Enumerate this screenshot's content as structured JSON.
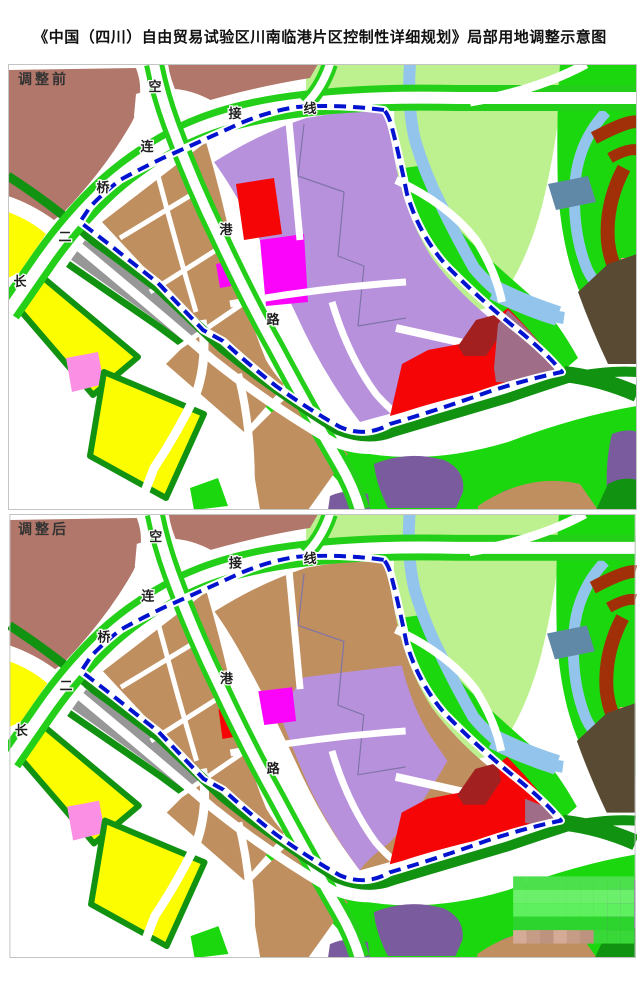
{
  "title": "《中国（四川）自由贸易试验区川南临港片区控制性详细规划》局部用地调整示意图",
  "panels": [
    {
      "id": "before",
      "label": "调整前"
    },
    {
      "id": "after",
      "label": "调整后"
    }
  ],
  "road_labels": [
    {
      "char": "空"
    },
    {
      "char": "港"
    },
    {
      "char": "路"
    },
    {
      "char": "长"
    },
    {
      "char": "二"
    },
    {
      "char": "桥"
    },
    {
      "char": "连"
    },
    {
      "char": "接"
    },
    {
      "char": "线"
    }
  ],
  "colors": {
    "white": "#ffffff",
    "paleGreen": "#bdf18f",
    "brightGreen": "#1bd80e",
    "roadGreen": "#23cf18",
    "darkGreen": "#119211",
    "yellow": "#fdfd02",
    "tan": "#c08f5f",
    "rosybrown": "#b1776a",
    "darkBrown": "#584a33",
    "purpleLight": "#b891dc",
    "purpleDark": "#7a5b9e",
    "magenta": "#fa04fa",
    "pink": "#fb8fe3",
    "red": "#f50505",
    "maroon": "#a32020",
    "arcRed": "#a13008",
    "mauve": "#a06d88",
    "gray": "#979797",
    "steelBlue": "#6089a8",
    "lightBlue": "#93c5ec",
    "salmon": "#f4a88c",
    "dashBlue": "#0213cf",
    "meander": "#7f74a8",
    "mapBorder": "#c4c4c4",
    "label": "#1f1f1f",
    "watermarkGreens": [
      "#4ce04c",
      "#5ff05f",
      "#39d839",
      "#6cf06c",
      "#2ed42e"
    ],
    "watermarkEarth": [
      "#c79c86",
      "#d4ab96",
      "#bd937f"
    ]
  }
}
